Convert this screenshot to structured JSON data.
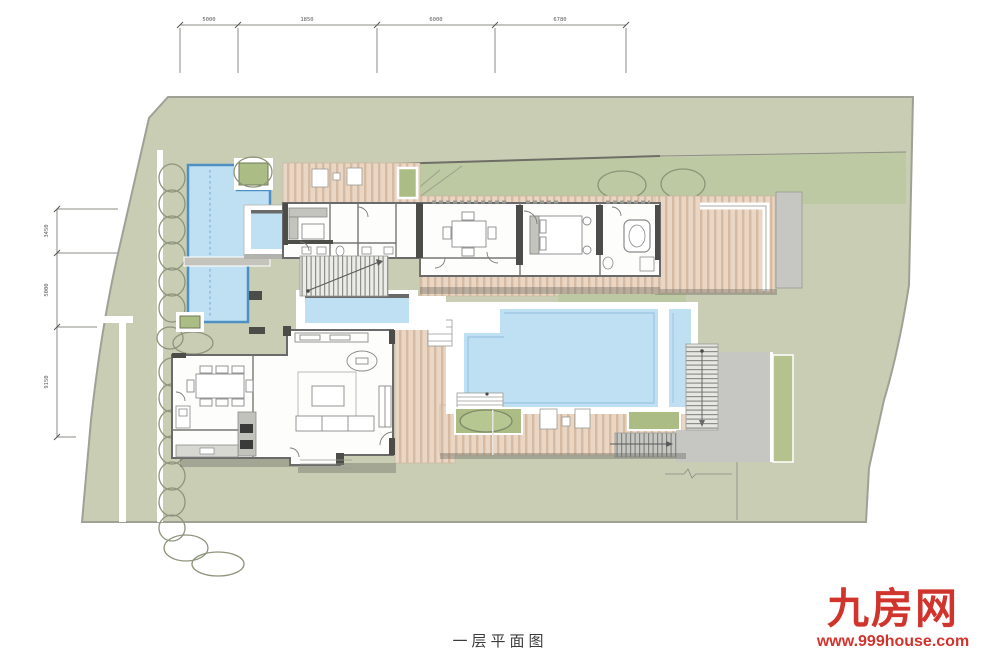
{
  "title": {
    "caption": "一层平面图"
  },
  "logo": {
    "brand": "九房网",
    "url": "www.999house.com",
    "color": "#d0342c"
  },
  "dimensions": {
    "top": [
      "5000",
      "1850",
      "6000",
      "6780"
    ],
    "left": [
      "3450",
      "5000",
      "9150"
    ]
  },
  "colors": {
    "site_green": "#c8cdb4",
    "lawn_green": "#bdc9a2",
    "planter_green": "#abbd85",
    "deck_tan": "#e9d6c4",
    "deck_stripe": "#d6bba2",
    "pool_blue": "#bfe0f3",
    "pool_edge_blue": "#4e8fc4",
    "terrace_gray": "#c6c7c2",
    "wall_gray": "#6a6a6a",
    "logo_red": "#d0342c",
    "text_dark": "#3c3c3c"
  }
}
